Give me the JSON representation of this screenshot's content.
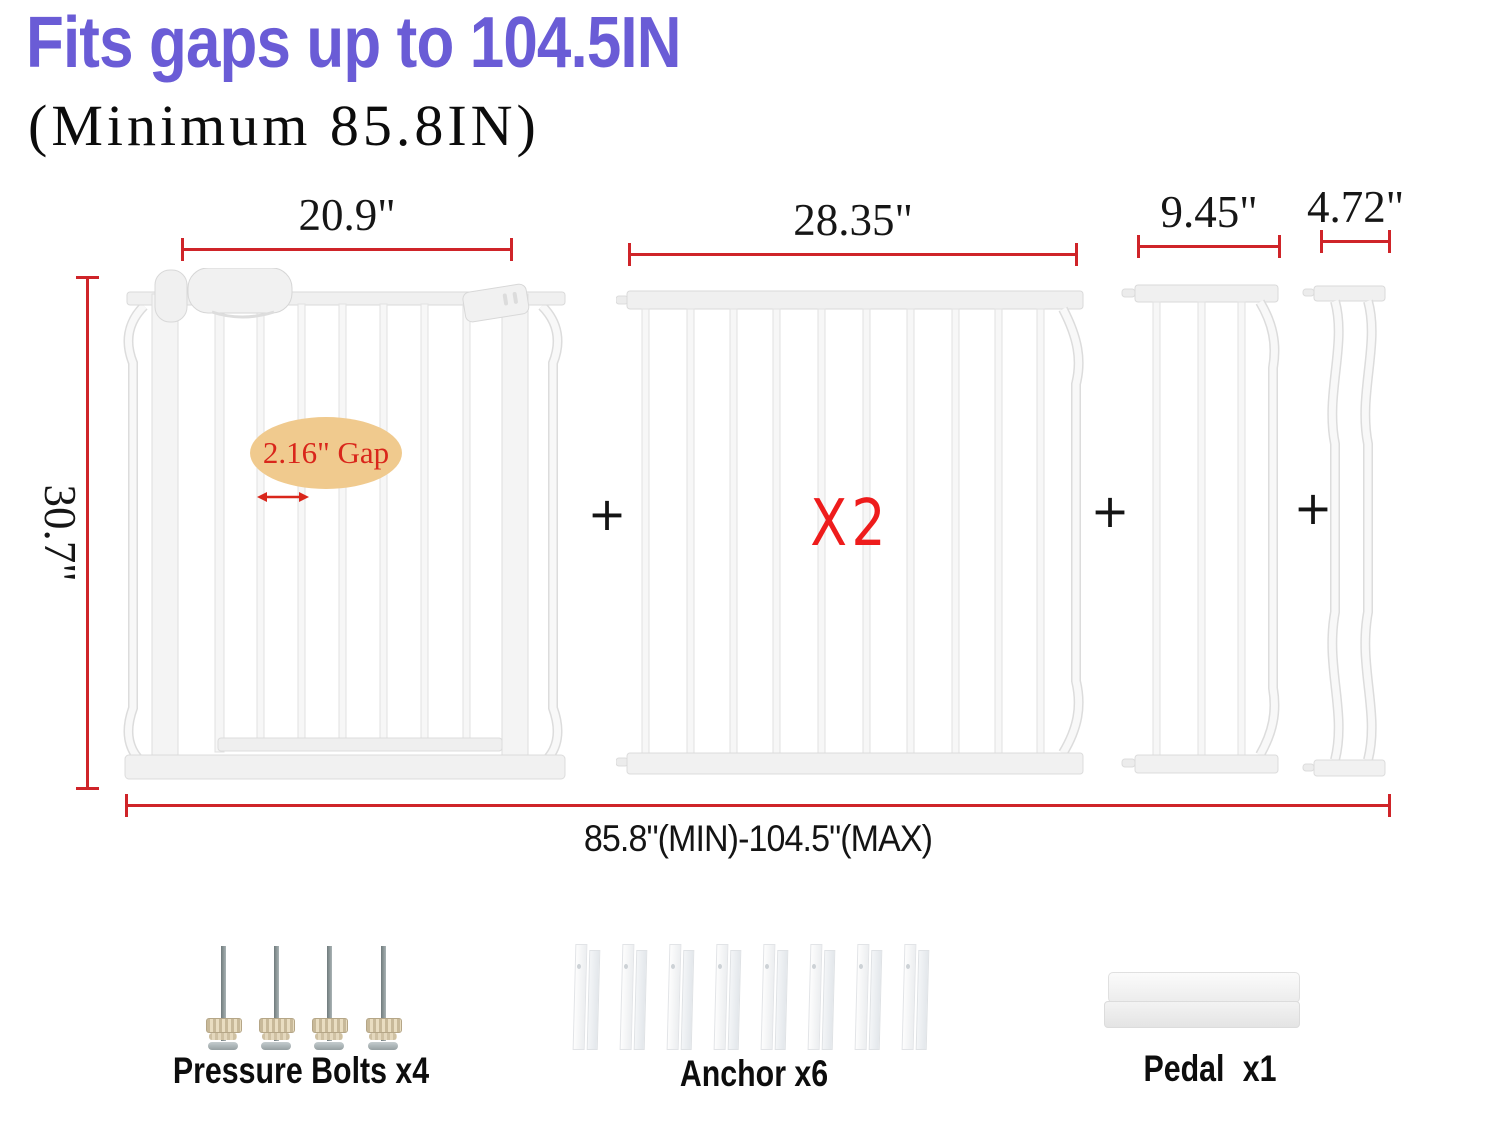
{
  "header": {
    "title": "Fits gaps up to 104.5IN",
    "subtitle": "(Minimum 85.8IN)"
  },
  "colors": {
    "title_blue": "#6a5cd6",
    "dimension_line_red": "#cf2429",
    "accent_red": "#ee1c1c",
    "gap_ellipse_tan": "#f0ca8e",
    "gap_text_red": "#d9261b"
  },
  "dimensions": {
    "panel1": "20.9\"",
    "panel2": "28.35\"",
    "panel3": "9.45\"",
    "panel4": "4.72\"",
    "height": "30.7\"",
    "total_range": "85.8\"(MIN)-104.5\"(MAX)",
    "gap": "2.16\" Gap"
  },
  "annotations": {
    "multiplier": "X2",
    "plus": "+"
  },
  "parts": {
    "bolts": {
      "label": "Pressure Bolts x4",
      "shown": 4
    },
    "anchors": {
      "label": "Anchor x6",
      "shown": 8
    },
    "pedal": {
      "label": "Pedal  x1",
      "shown": 1
    }
  }
}
